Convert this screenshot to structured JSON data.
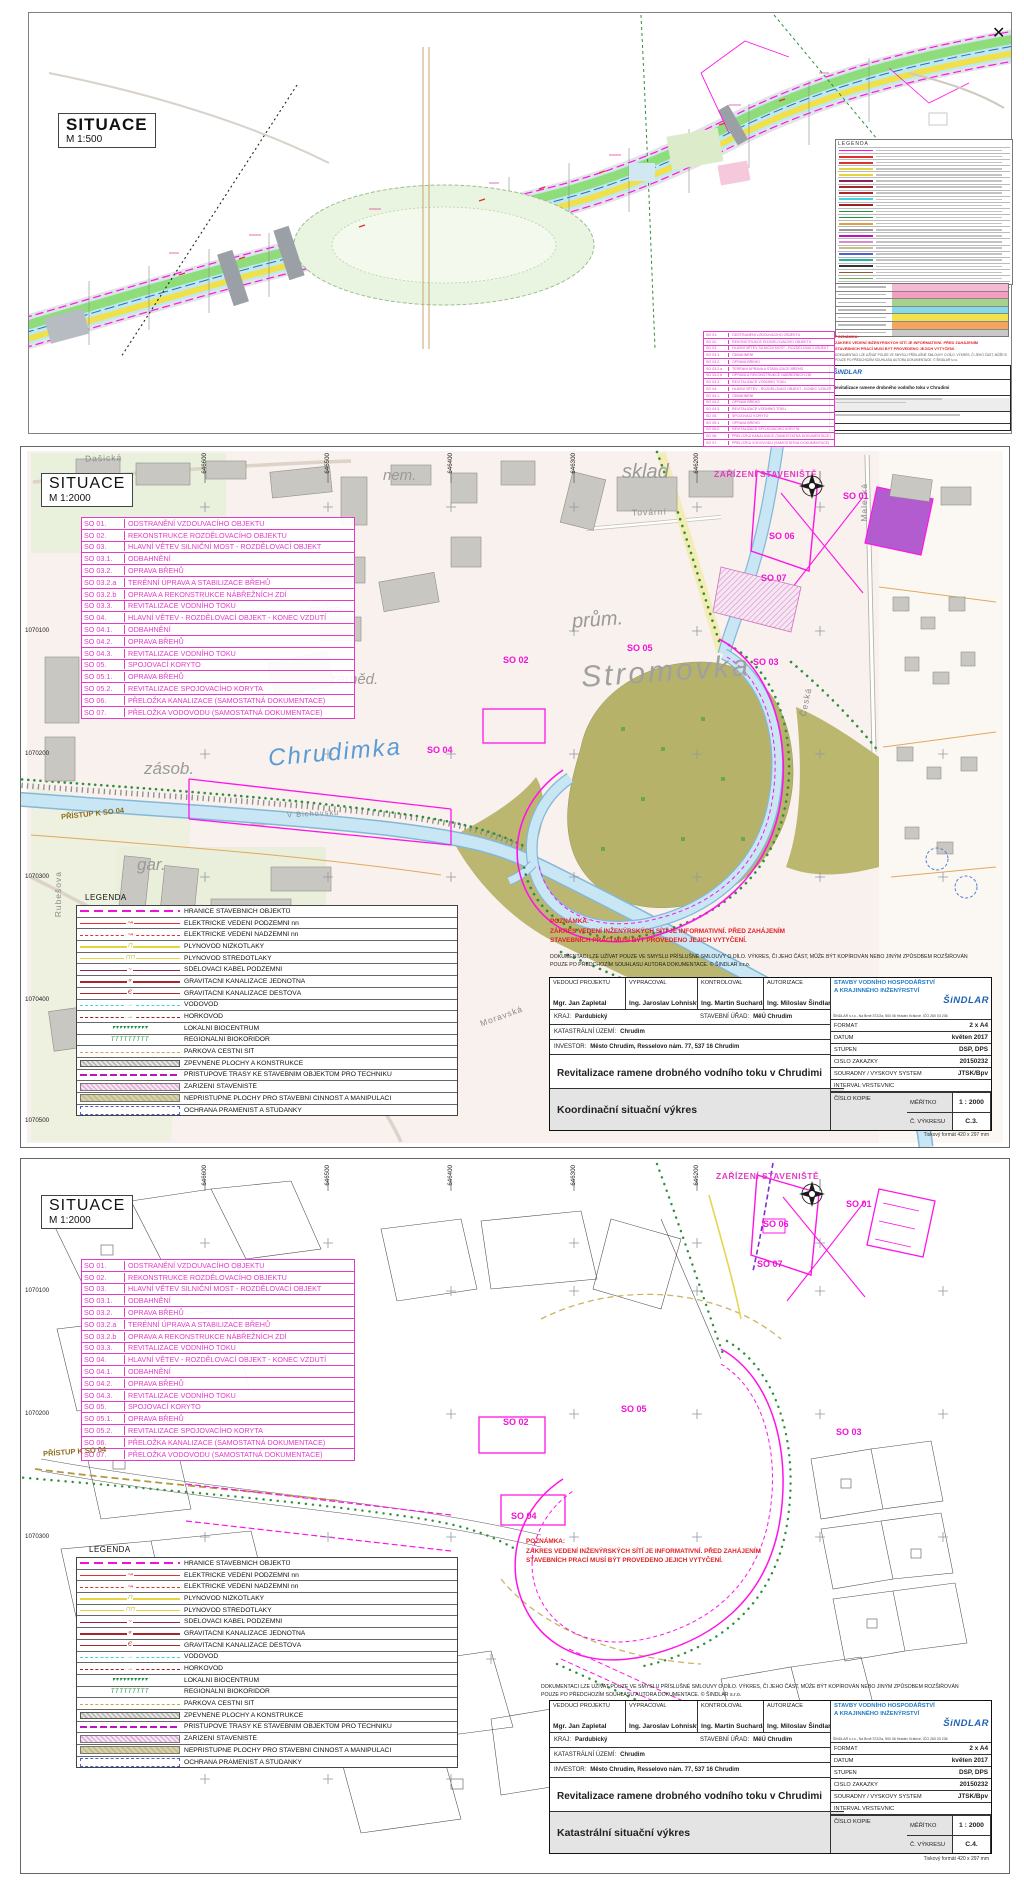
{
  "sheets": {
    "s500": {
      "title": "SITUACE",
      "scale": "M 1:500"
    },
    "coord": {
      "title": "SITUACE",
      "scale": "M 1:2000",
      "drawing_name": "Koordinační situační výkres",
      "drawing_number": "C.3."
    },
    "kat": {
      "title": "SITUACE",
      "scale": "M 1:2000",
      "drawing_name": "Katastrální situační výkres",
      "drawing_number": "C.4."
    }
  },
  "so_list": [
    {
      "code": "SO 01.",
      "label": "ODSTRANĚNÍ VZDOUVACÍHO OBJEKTU"
    },
    {
      "code": "SO 02.",
      "label": "REKONSTRUKCE ROZDĚLOVACÍHO OBJEKTU"
    },
    {
      "code": "SO 03.",
      "label": "HLAVNÍ VĚTEV SILNIČNÍ MOST - ROZDĚLOVACÍ OBJEKT"
    },
    {
      "code": "SO 03.1.",
      "label": "ODBAHNĚNÍ"
    },
    {
      "code": "SO 03.2.",
      "label": "OPRAVA BŘEHŮ"
    },
    {
      "code": "SO 03.2.a",
      "label": "TERÉNNÍ ÚPRAVA A STABILIZACE BŘEHŮ"
    },
    {
      "code": "SO 03.2.b",
      "label": "OPRAVA A REKONSTRUKCE NÁBŘEŽNÍCH ZDÍ"
    },
    {
      "code": "SO 03.3.",
      "label": "REVITALIZACE VODNÍHO TOKU"
    },
    {
      "code": "SO 04.",
      "label": "HLAVNÍ VĚTEV - ROZDĚLOVACÍ OBJEKT - KONEC VZDUTÍ"
    },
    {
      "code": "SO 04.1.",
      "label": "ODBAHNĚNÍ"
    },
    {
      "code": "SO 04.2.",
      "label": "OPRAVA BŘEHŮ"
    },
    {
      "code": "SO 04.3.",
      "label": "REVITALIZACE VODNÍHO TOKU"
    },
    {
      "code": "SO 05.",
      "label": "SPOJOVACÍ KORYTO"
    },
    {
      "code": "SO 05.1.",
      "label": "OPRAVA BŘEHŮ"
    },
    {
      "code": "SO 05.2.",
      "label": "REVITALIZACE SPOJOVACÍHO KORYTA"
    },
    {
      "code": "SO 06.",
      "label": "PŘELOŽKA KANALIZACE (SAMOSTATNÁ DOKUMENTACE)"
    },
    {
      "code": "SO 07.",
      "label": "PŘELOŽKA VODOVODU (SAMOSTATNÁ DOKUMENTACE)"
    }
  ],
  "legend": {
    "title": "LEGENDA",
    "items": [
      {
        "label": "HRANICE STAVEBNÍCH OBJEKTŮ",
        "swatch": "sw-hranice",
        "glyph": ""
      },
      {
        "label": "ELEKTRICKÉ VEDENÍ PODZEMNÍ nn",
        "swatch": "sw-el-pod",
        "glyph": "↝"
      },
      {
        "label": "ELEKTRICKÉ VEDENÍ NADZEMNÍ nn",
        "swatch": "sw-el-nad",
        "glyph": "↝"
      },
      {
        "label": "PLYNOVOD NÍZKOTLAKÝ",
        "swatch": "sw-plyn",
        "glyph": "⊓"
      },
      {
        "label": "PLYNOVOD STŘEDOTLAKÝ",
        "swatch": "sw-plyn",
        "glyph": "⊓⊓"
      },
      {
        "label": "SDĚLOVACÍ KABEL PODZEMNÍ",
        "swatch": "sw-sdel",
        "glyph": "~"
      },
      {
        "label": "GRAVITAČNÍ KANALIZACE JEDNOTNÁ",
        "swatch": "sw-kan",
        "glyph": "«"
      },
      {
        "label": "GRAVITAČNÍ KANALIZACE DEŠŤOVÁ",
        "swatch": "sw-kan",
        "glyph": "Є"
      },
      {
        "label": "VODOVOD",
        "swatch": "sw-vodovod",
        "glyph": "→"
      },
      {
        "label": "HORKOVOD",
        "swatch": "sw-horkovod",
        "glyph": "→"
      },
      {
        "label": "LOKÁLNÍ BIOCENTRUM",
        "swatch": "sw-bio",
        "glyph": "▾▾▾▾▾▾▾▾▾▾"
      },
      {
        "label": "REGIONÁLNÍ BIOKORIDOR",
        "swatch": "sw-bio",
        "glyph": "TTTTTTTTT"
      },
      {
        "label": "PARKOVÁ CESTNÍ SÍŤ",
        "swatch": "sw-park",
        "glyph": ""
      },
      {
        "label": "ZPEVNĚNÉ PLOCHY A KONSTRUKCE",
        "swatch": "sw-zpevnene",
        "glyph": ""
      },
      {
        "label": "PŘÍSTUPOVÉ TRASY KE STAVEBNÍM OBJEKTŮM PRO TECHNIKU",
        "swatch": "sw-pristup",
        "glyph": ""
      },
      {
        "label": "ZAŘÍZENÍ STAVENIŠTĚ",
        "swatch": "sw-zarizeni",
        "glyph": ""
      },
      {
        "label": "NEPŘÍSTUPNÉ PLOCHY PRO STAVEBNÍ ČINNOST A MANIPULACI",
        "swatch": "sw-nepristupne",
        "glyph": ""
      },
      {
        "label": "OCHRANA PRAMENIŠŤ A STUDÁNKY",
        "swatch": "sw-ochrana",
        "glyph": ""
      }
    ]
  },
  "note": {
    "heading": "POZNÁMKA:",
    "line1": "ZÁKRES VEDENÍ INŽENÝRSKÝCH SÍTÍ JE INFORMATIVNÍ. PŘED ZAHÁJENÍM",
    "line2": "STAVEBNÍCH PRACÍ MUSÍ BÝT  PROVEDENO JEJICH VYTYČENÍ."
  },
  "copyright": {
    "line1": "DOKUMENTACI LZE UŽÍVAT POUZE VE SMYSLU PŘÍSLUŠNÉ SMLOUVY O DÍLO. VÝKRES, ČI JEHO ČÁST, MŮŽE BÝT KOPÍROVÁN NEBO JINÝM ZPŮSOBEM ROZŠIŘOVÁN",
    "line2": "POUZE PO PŘEDCHOZÍM SOUHLASU AUTORA DOKUMENTACE.   ©   ŠINDLAR s.r.o."
  },
  "titleblock": {
    "roles": [
      {
        "role": "VEDOUCÍ PROJEKTU",
        "name": "Mgr. Jan Zapletal"
      },
      {
        "role": "VYPRACOVAL",
        "name": "Ing. Jaroslav Lohniský"
      },
      {
        "role": "KONTROLOVAL",
        "name": "Ing. Martin Sucharda"
      },
      {
        "role": "AUTORIZACE",
        "name": "Ing. Miloslav Šindlar"
      }
    ],
    "kraj_label": "KRAJ:",
    "kraj": "Pardubický",
    "stavebni_urad_label": "STAVEBNÍ ÚŘAD:",
    "stavebni_urad": "MěÚ Chrudim",
    "katastr_label": "KATASTRÁLNÍ ÚZEMÍ:",
    "katastr": "Chrudim",
    "investor_label": "INVESTOR:",
    "investor": "Město Chrudim, Resselovo nám. 77, 537 16 Chrudim",
    "project": "Revitalizace ramene drobného vodního toku v Chrudimi",
    "company_line1": "STAVBY VODNÍHO HOSPODÁŘSTVÍ",
    "company_line2": "A KRAJINNÉHO INŽENÝRSTVÍ",
    "company_brand": "ŠiNDLAR",
    "company_address": "ŠINDLAR s.r.o., Na Brně 372/2a, 500 06 Hradec Králové, IČO 260 03 236",
    "fields": [
      {
        "label": "FORMÁT",
        "value": "2 x A4"
      },
      {
        "label": "DATUM",
        "value": "květen 2017"
      },
      {
        "label": "STUPEŇ",
        "value": "DSP, DPS"
      },
      {
        "label": "ČÍSLO ZAKÁZKY",
        "value": "20150232"
      },
      {
        "label": "SOUŘADNÝ / VÝŠKOVÝ SYSTÉM",
        "value": "JTSK/Bpv"
      },
      {
        "label": "INTERVAL VRSTEVNIC",
        "value": ""
      }
    ],
    "meritko_label": "MĚŘÍTKO",
    "meritko": "1 : 2000",
    "cislo_kopie_label": "ČÍSLO KOPIE",
    "vykres_label": "Č. VÝKRESU",
    "print_format": "Tiskový formát 420 x 297 mm"
  },
  "map_labels": {
    "river": "Chrudimka",
    "park": "Stromovka",
    "sklad": "sklad",
    "nem": "nem.",
    "prum": "prům.",
    "zemed": "zeměd.",
    "zasob": "zásob.",
    "gar": "gar.",
    "tovarni": "Tovární",
    "dasicka": "Dašická",
    "malecka": "Malecká",
    "rubesova": "Rubešova",
    "moravska": "Moravská",
    "ceska": "Česká",
    "v_bichovsku": "V Bichovsku",
    "pristup": "PŘÍSTUP K SO 04",
    "zarizeni": "ZAŘÍZENÍ STAVENIŠTĚ"
  },
  "so_badges": [
    "SO 01",
    "SO 02",
    "SO 03",
    "SO 04",
    "SO 05",
    "SO 06",
    "SO 07"
  ],
  "coords": {
    "eastings": [
      "646600",
      "646500",
      "646400",
      "646300",
      "646200",
      "646100"
    ],
    "northings": [
      "1070100",
      "1070200",
      "1070300",
      "1070400",
      "1070500"
    ]
  }
}
